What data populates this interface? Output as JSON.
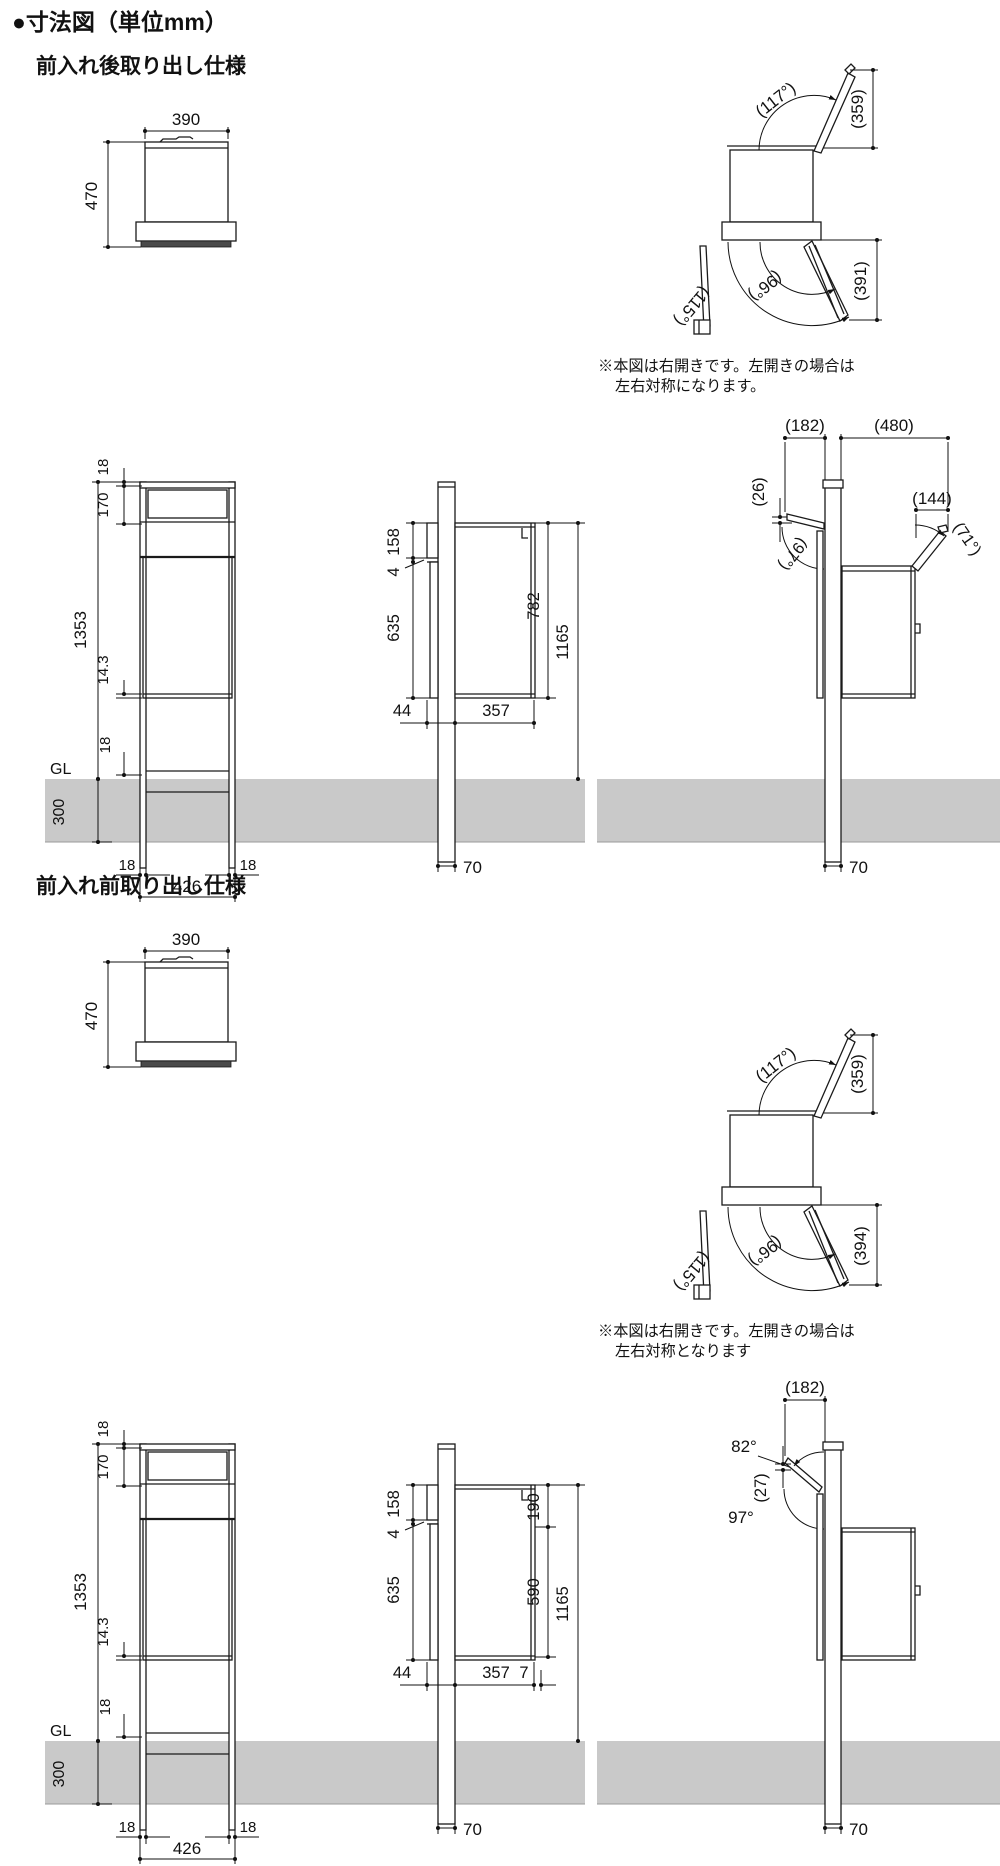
{
  "header": {
    "title": "●寸法図（単位mm）"
  },
  "s1": {
    "title": "前入れ後取り出し仕様",
    "front": {
      "w": "390",
      "h": "470"
    },
    "open": {
      "lid_angle": "(117°)",
      "lid_h": "(359)",
      "door_inner": "(96°)",
      "door_outer": "(115°)",
      "door_h": "(391)"
    },
    "note1": "※本図は右開きです。左開きの場合は",
    "note2": "左右対称になります。",
    "elev": {
      "t18": "18",
      "t170": "170",
      "h": "1353",
      "t143": "14.3",
      "gl": "GL",
      "g18": "18",
      "depth": "300",
      "b18l": "18",
      "b426": "426",
      "b18r": "18"
    },
    "side": {
      "t158": "158",
      "t4": "4",
      "t635": "635",
      "d782": "782",
      "d1165": "1165",
      "b44": "44",
      "b357": "357",
      "pole": "70"
    },
    "open2": {
      "d182": "(182)",
      "d480": "(480)",
      "d26": "(26)",
      "d144": "(144)",
      "a71": "(71°)",
      "a97": "(97°)",
      "pole": "70"
    }
  },
  "s2": {
    "title": "前入れ前取り出し仕様",
    "front": {
      "w": "390",
      "h": "470"
    },
    "open": {
      "lid_angle": "(117°)",
      "lid_h": "(359)",
      "door_inner": "(96°)",
      "door_outer": "(115°)",
      "door_h": "(394)"
    },
    "note1": "※本図は右開きです。左開きの場合は",
    "note2": "左右対称となります",
    "elev": {
      "t18": "18",
      "t170": "170",
      "h": "1353",
      "t143": "14.3",
      "gl": "GL",
      "g18": "18",
      "depth": "300",
      "b18l": "18",
      "b426": "426",
      "b18r": "18"
    },
    "side": {
      "t158": "158",
      "t4": "4",
      "t635": "635",
      "d190": "190",
      "d590": "590",
      "d1165": "1165",
      "b44": "44",
      "b357": "357",
      "b7": "7",
      "pole": "70"
    },
    "open2": {
      "d182": "(182)",
      "a82": "82°",
      "d27": "(27)",
      "a97": "97°",
      "pole": "70"
    }
  }
}
